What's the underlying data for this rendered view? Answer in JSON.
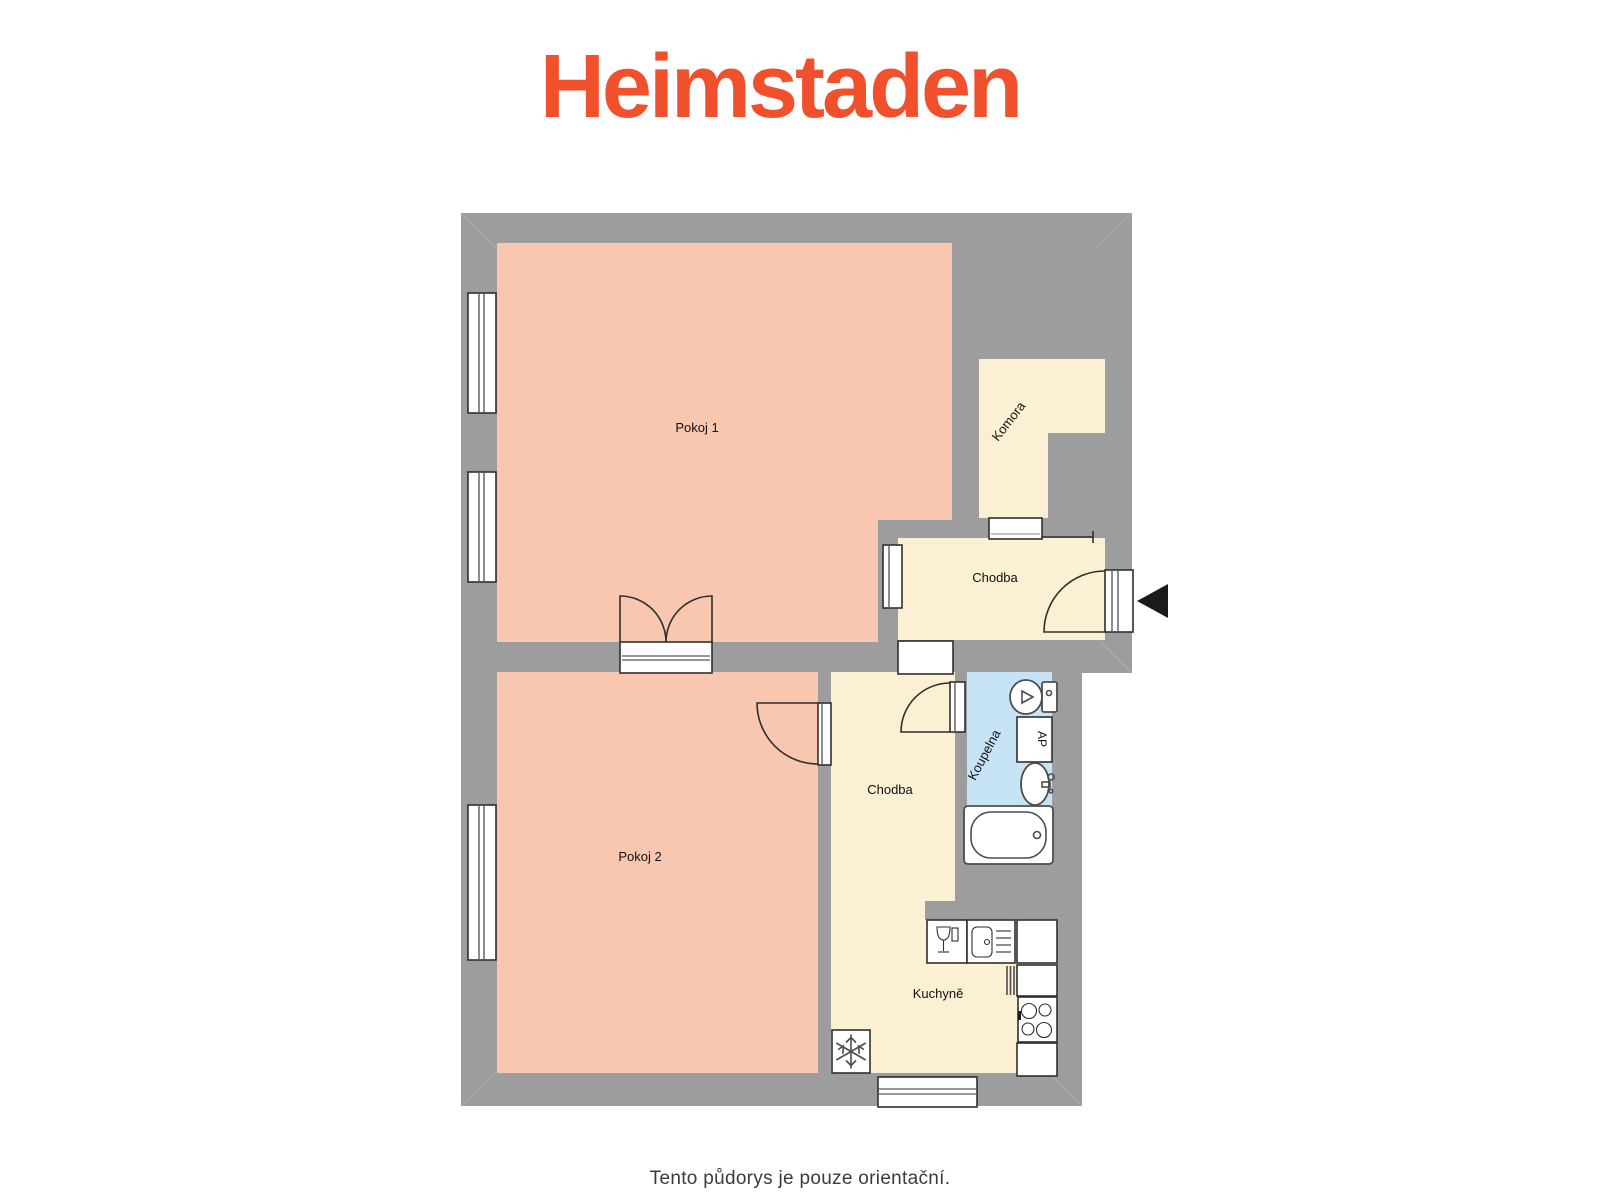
{
  "logo": {
    "text": "Heimstaden"
  },
  "caption": {
    "text": "Tento půdorys je pouze orientační."
  },
  "floor_plan": {
    "rooms": {
      "pokoj1": {
        "label": "Pokoj 1"
      },
      "pokoj2": {
        "label": "Pokoj 2"
      },
      "chodba_upper": {
        "label": "Chodba"
      },
      "chodba_lower": {
        "label": "Chodba"
      },
      "komora": {
        "label": "Komora"
      },
      "koupelna": {
        "label": "Koupelna"
      },
      "kuchyne": {
        "label": "Kuchyně"
      }
    },
    "fixtures": {
      "washing_machine": {
        "label": "AP"
      }
    },
    "entrance": {
      "marker": "arrow-left"
    }
  },
  "colors": {
    "wall": "#9D9D9D",
    "room-warm": "#F9C6B0",
    "room-cream": "#FCF0D4",
    "room-blue": "#C7E3F6",
    "line": "#2F2F2F",
    "fixline": "#4D4D4D",
    "accent": "#F1502C",
    "caption": "#3B3B3B",
    "label": "#111111"
  }
}
